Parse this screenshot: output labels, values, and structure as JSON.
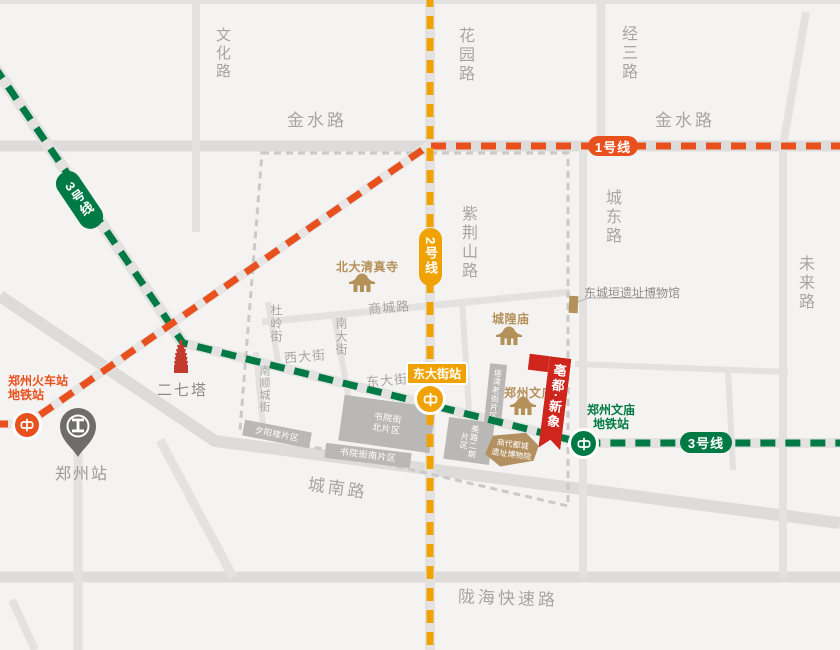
{
  "labels": {
    "wenhua": "文化路",
    "jinshui_west": "金水路",
    "jinshui_east": "金水路",
    "huayuan": "花园路",
    "jingsan": "经三路",
    "chengdong": "城东路",
    "weilai": "未来路",
    "zijingshan": "紫荆山路",
    "shangcheng": "商城路",
    "duling": "杜岭街",
    "nandajie": "南大街",
    "xidajie": "西大街",
    "dongdajie": "东大街",
    "nanshuncheng": "南顺城街",
    "chengnan": "城南路",
    "longhai": "陇海快速路"
  },
  "metro": {
    "line1": {
      "label": "1号线",
      "color": "#e8501e"
    },
    "line2": {
      "label": "2号线",
      "color": "#f0a202"
    },
    "line3": {
      "label": "3号线",
      "color": "#007a45"
    }
  },
  "stations": {
    "railway": {
      "line1": "郑州火车站",
      "line2": "地铁站"
    },
    "dongdajie": "东大街站",
    "wenmiao": {
      "line1": "郑州文庙",
      "line2": "地铁站"
    },
    "zhengzhou": "郑州站"
  },
  "pois": {
    "erqi_tower": "二七塔",
    "beida_mosque": "北大清真寺",
    "chenghuang_temple": "城隍庙",
    "zhengzhou_confucian_temple": "郑州文庙",
    "dongchengyuan_museum": "东城垣遗址博物馆",
    "project_name": "亳都·新象",
    "shangdu_museum_line1": "商代都城",
    "shangdu_museum_line2": "遗址博物院"
  },
  "districts": {
    "shuyuan_north": "书院街北片区",
    "shuyuan_south": "书院街南片区",
    "xiyanglou": "夕阳楼片区",
    "meilu_phase2": "美路二期片区",
    "tawan_old_street": "塔湾老街片区"
  }
}
